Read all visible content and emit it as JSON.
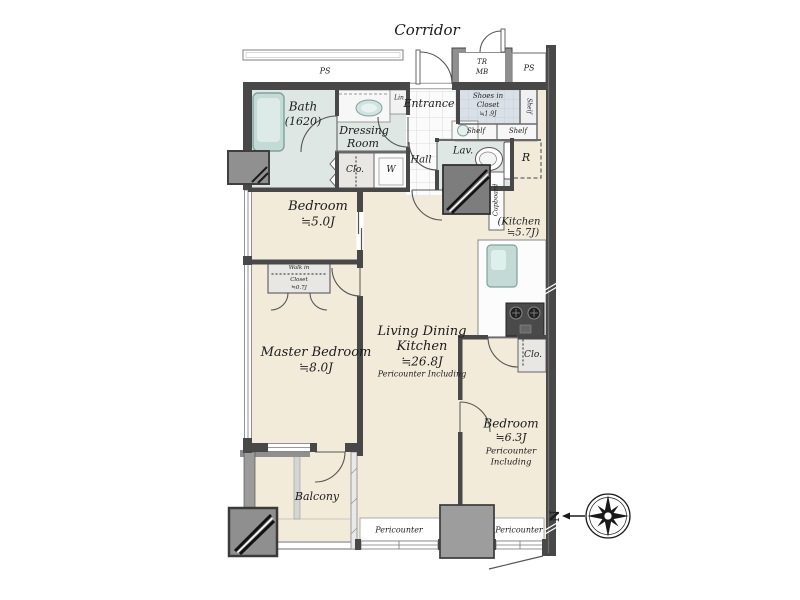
{
  "labels": {
    "corridor": "Corridor",
    "ps_top": "PS",
    "ps_right": "PS",
    "tr": "TR",
    "mb": "MB",
    "lin": "Lin",
    "shelf_side": "Shelf",
    "shelf_a": "Shelf",
    "shelf_b": "Shelf",
    "refrigerator": "R",
    "washer": "W",
    "closet_1": "Clo.",
    "closet_2": "Clo.",
    "cupboard": "Cupboard",
    "pericounter_left": "Pericounter",
    "pericounter_right": "Pericounter",
    "north": "N"
  },
  "rooms": {
    "entrance": {
      "name": "Entrance"
    },
    "hall": {
      "name": "Hall"
    },
    "bath": {
      "name": "Bath",
      "size": "(1620)"
    },
    "dressing_room": {
      "name_line1": "Dressing",
      "name_line2": "Room"
    },
    "shoes_in_closet": {
      "name_line1": "Shoes in",
      "name_line2": "Closet",
      "size": "≒1.9J"
    },
    "lavatory": {
      "name": "Lav."
    },
    "bedroom_1": {
      "name": "Bedroom",
      "size": "≒5.0J"
    },
    "kitchen": {
      "name_line1": "(Kitchen",
      "name_line2": "≒5.7J)"
    },
    "walk_in_closet": {
      "name_line1": "Walk in",
      "name_line2": "Closet",
      "size": "≒0.7J"
    },
    "master_bedroom": {
      "name": "Master Bedroom",
      "size": "≒8.0J"
    },
    "living_dining_kitchen": {
      "name_line1": "Living Dining",
      "name_line2": "Kitchen",
      "size": "≒26.8J",
      "note": "Pericounter Including"
    },
    "bedroom_2": {
      "name": "Bedroom",
      "size": "≒6.3J",
      "note_line1": "Pericounter",
      "note_line2": "Including"
    },
    "balcony": {
      "name": "Balcony"
    }
  },
  "colors": {
    "wall": "#484848",
    "floor": "#f2ebda",
    "wet_area": "#dfe7e4",
    "shoes_closet": "#dae0e7",
    "closet": "#e8e7e3",
    "fixture_teal": "#c3dad5",
    "column": "#8f8f8f"
  }
}
